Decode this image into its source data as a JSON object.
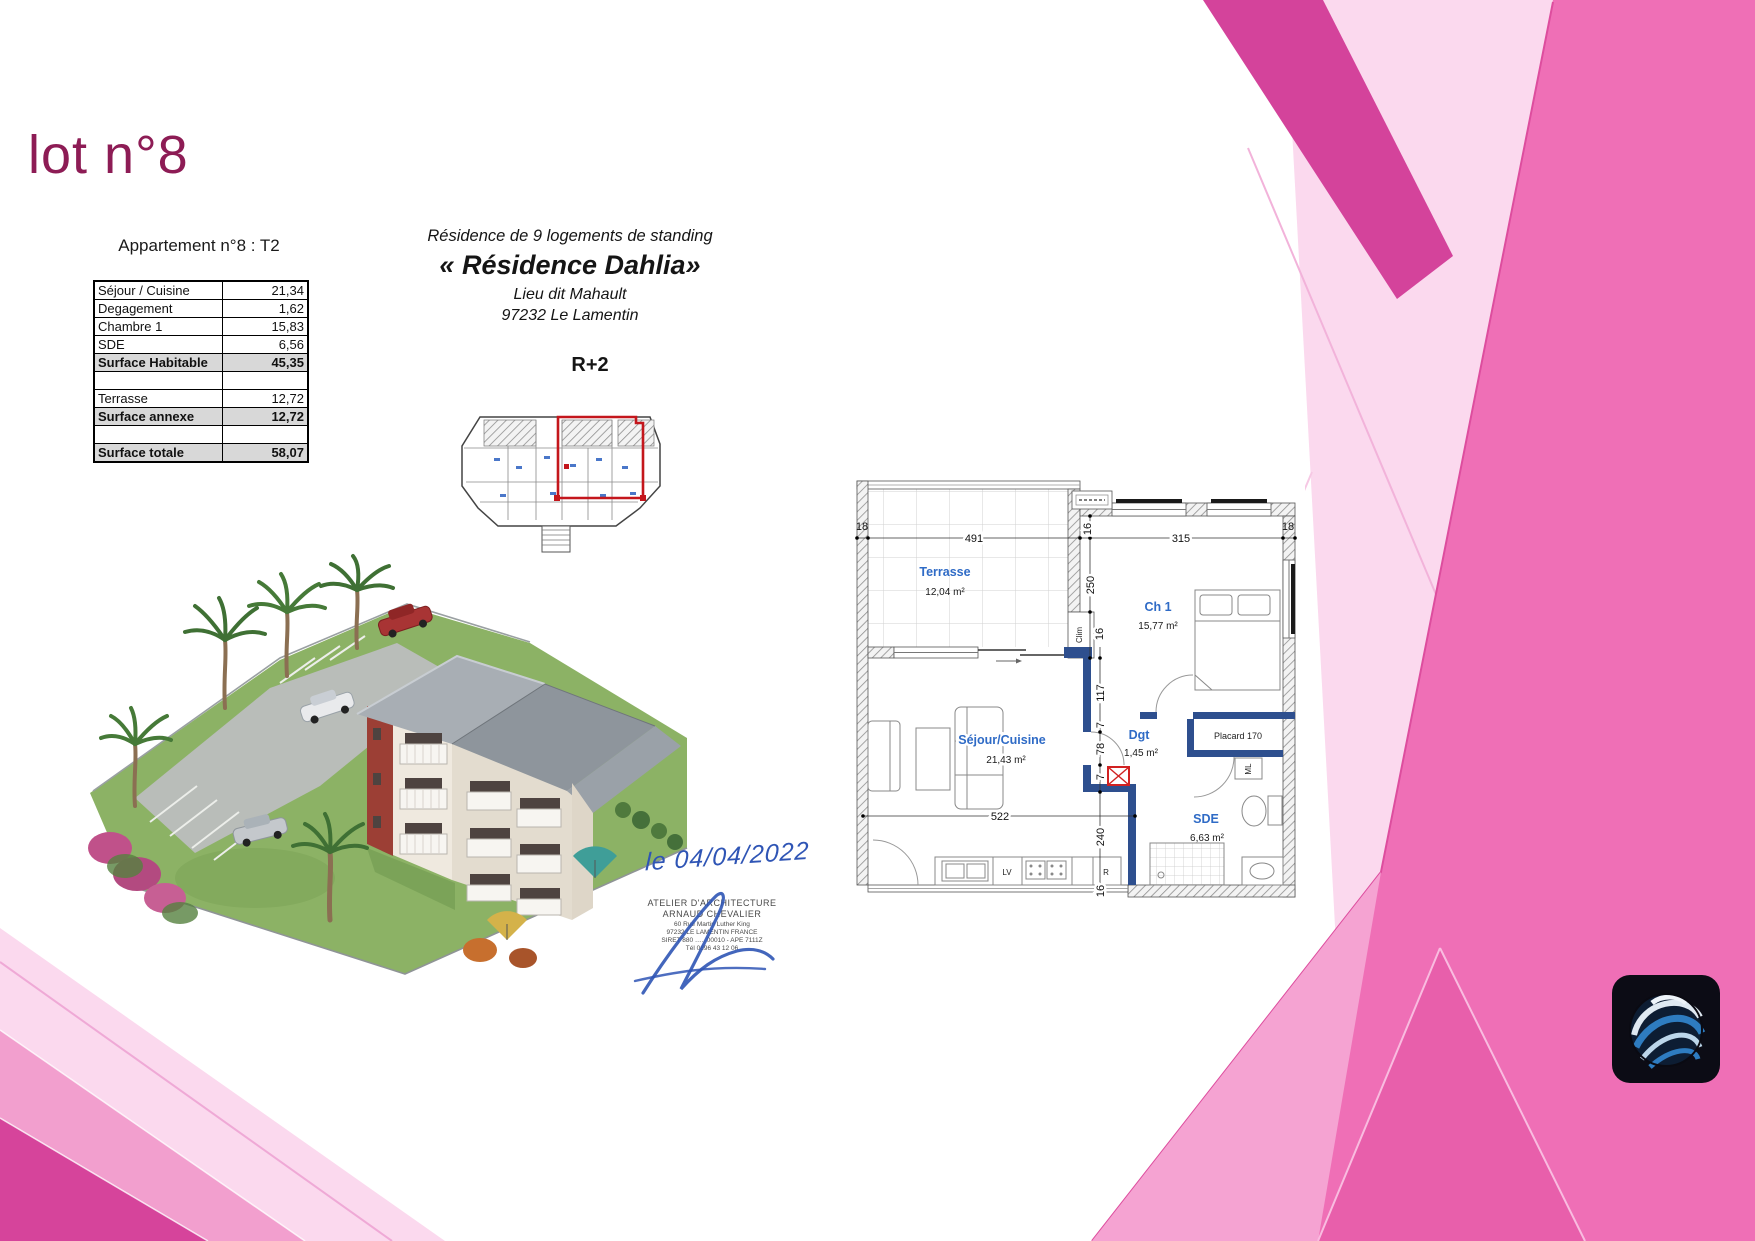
{
  "slide": {
    "title": "lot n°8"
  },
  "apartment_table": {
    "heading": "Appartement n°8 : T2",
    "rows": [
      {
        "label": "Séjour / Cuisine",
        "value": "21,34"
      },
      {
        "label": "Degagement",
        "value": "1,62"
      },
      {
        "label": "Chambre 1",
        "value": "15,83"
      },
      {
        "label": "SDE",
        "value": "6,56"
      },
      {
        "label": "Surface Habitable",
        "value": "45,35"
      },
      {
        "label": "",
        "value": ""
      },
      {
        "label": "Terrasse",
        "value": "12,72"
      },
      {
        "label": "Surface annexe",
        "value": "12,72"
      },
      {
        "label": "",
        "value": ""
      },
      {
        "label": "Surface totale",
        "value": "58,07"
      }
    ]
  },
  "residence": {
    "subtitle": "Résidence de 9 logements de standing",
    "name": "« Résidence Dahlia»",
    "place": "Lieu dit Mahault",
    "city": "97232 Le Lamentin",
    "level": "R+2"
  },
  "floorplan": {
    "rooms": {
      "terrasse": {
        "name": "Terrasse",
        "area": "12,04 m²"
      },
      "ch1": {
        "name": "Ch 1",
        "area": "15,77 m²"
      },
      "sejour": {
        "name": "Séjour/Cuisine",
        "area": "21,43 m²"
      },
      "dgt": {
        "name": "Dgt",
        "area": "1,45 m²"
      },
      "sde": {
        "name": "SDE",
        "area": "6,63 m²"
      }
    },
    "labels": {
      "placard": "Placard 170",
      "clim": "Clim",
      "ml": "ML",
      "lv": "LV",
      "fridge": "R"
    },
    "dims": {
      "top": [
        "18",
        "491",
        "16",
        "315",
        "18"
      ],
      "left": [
        "250",
        "16"
      ],
      "mid": [
        "117",
        "7",
        "78",
        "7"
      ],
      "bottom": [
        "522",
        "240",
        "16"
      ]
    }
  },
  "signature": {
    "date": "le 04/04/2022",
    "stamp": [
      "ATELIER D'ARCHITECTURE",
      "ARNAUD CHEVALIER",
      "60 Rue Martin Luther King",
      "97232 LE LAMENTIN FRANCE",
      "SIRET 880 ….. 00010 - APE 7111Z",
      "Tél 0696 43 12 06"
    ]
  },
  "colors": {
    "title": "#8D1C55",
    "pink_main": "#EF6FB6",
    "pink_deep": "#D4439B",
    "pink_pale": "#FBD9EE",
    "wall_blue": "#2E4F8E",
    "label_blue": "#2F6BC6",
    "plan_red": "#C4161C"
  }
}
